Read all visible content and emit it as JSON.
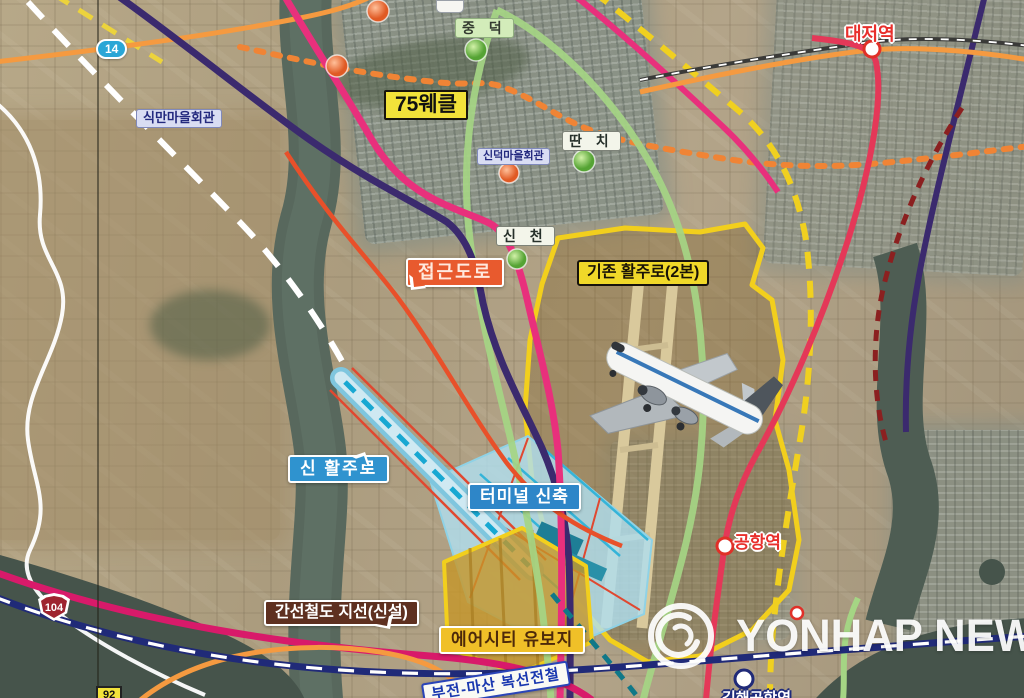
{
  "labels": {
    "sikman_hall": "식만마을회관",
    "jungdeok": "중 덕",
    "noise_contour": "75웨클",
    "sindeok_hall": "신덕마을회관",
    "ttanchi": "딴 치",
    "sincheon": "신 천",
    "access_road": "접근도로",
    "existing_runway": "기존 활주로(2본)",
    "new_runway": "신 활주로",
    "new_terminal": "터미널 신축",
    "trunk_rail_branch": "간선철도 지선(신설)",
    "aircity_reserve": "에어시티 유보지",
    "bujeon_masan_rail": "부전-마산 복선전철"
  },
  "stations": {
    "daejeo": "대저역",
    "gonghang": "공항역",
    "gimhae_airport": "김해공항역"
  },
  "road_shields": {
    "r14": "14",
    "r104": "104",
    "r92": "92"
  },
  "watermark": {
    "text": "YONHAP NEWS"
  },
  "colors": {
    "noise_box_yellow": "#f2e23a",
    "access_road_orange": "#e85a2e",
    "new_runway_blue": "#2f93cf",
    "rail_branch_brown": "#5e3020",
    "aircity_gold": "#f0c028",
    "station_red": "#e8302c",
    "lrt_pink": "#e8307c",
    "noise_loop_green": "#a5d584",
    "metro_purple": "#3b2a6e",
    "road_orange": "#f59a40",
    "planned_rail_navy": "#202a78",
    "airport_boundary_yellow": "#f2cf1d"
  }
}
